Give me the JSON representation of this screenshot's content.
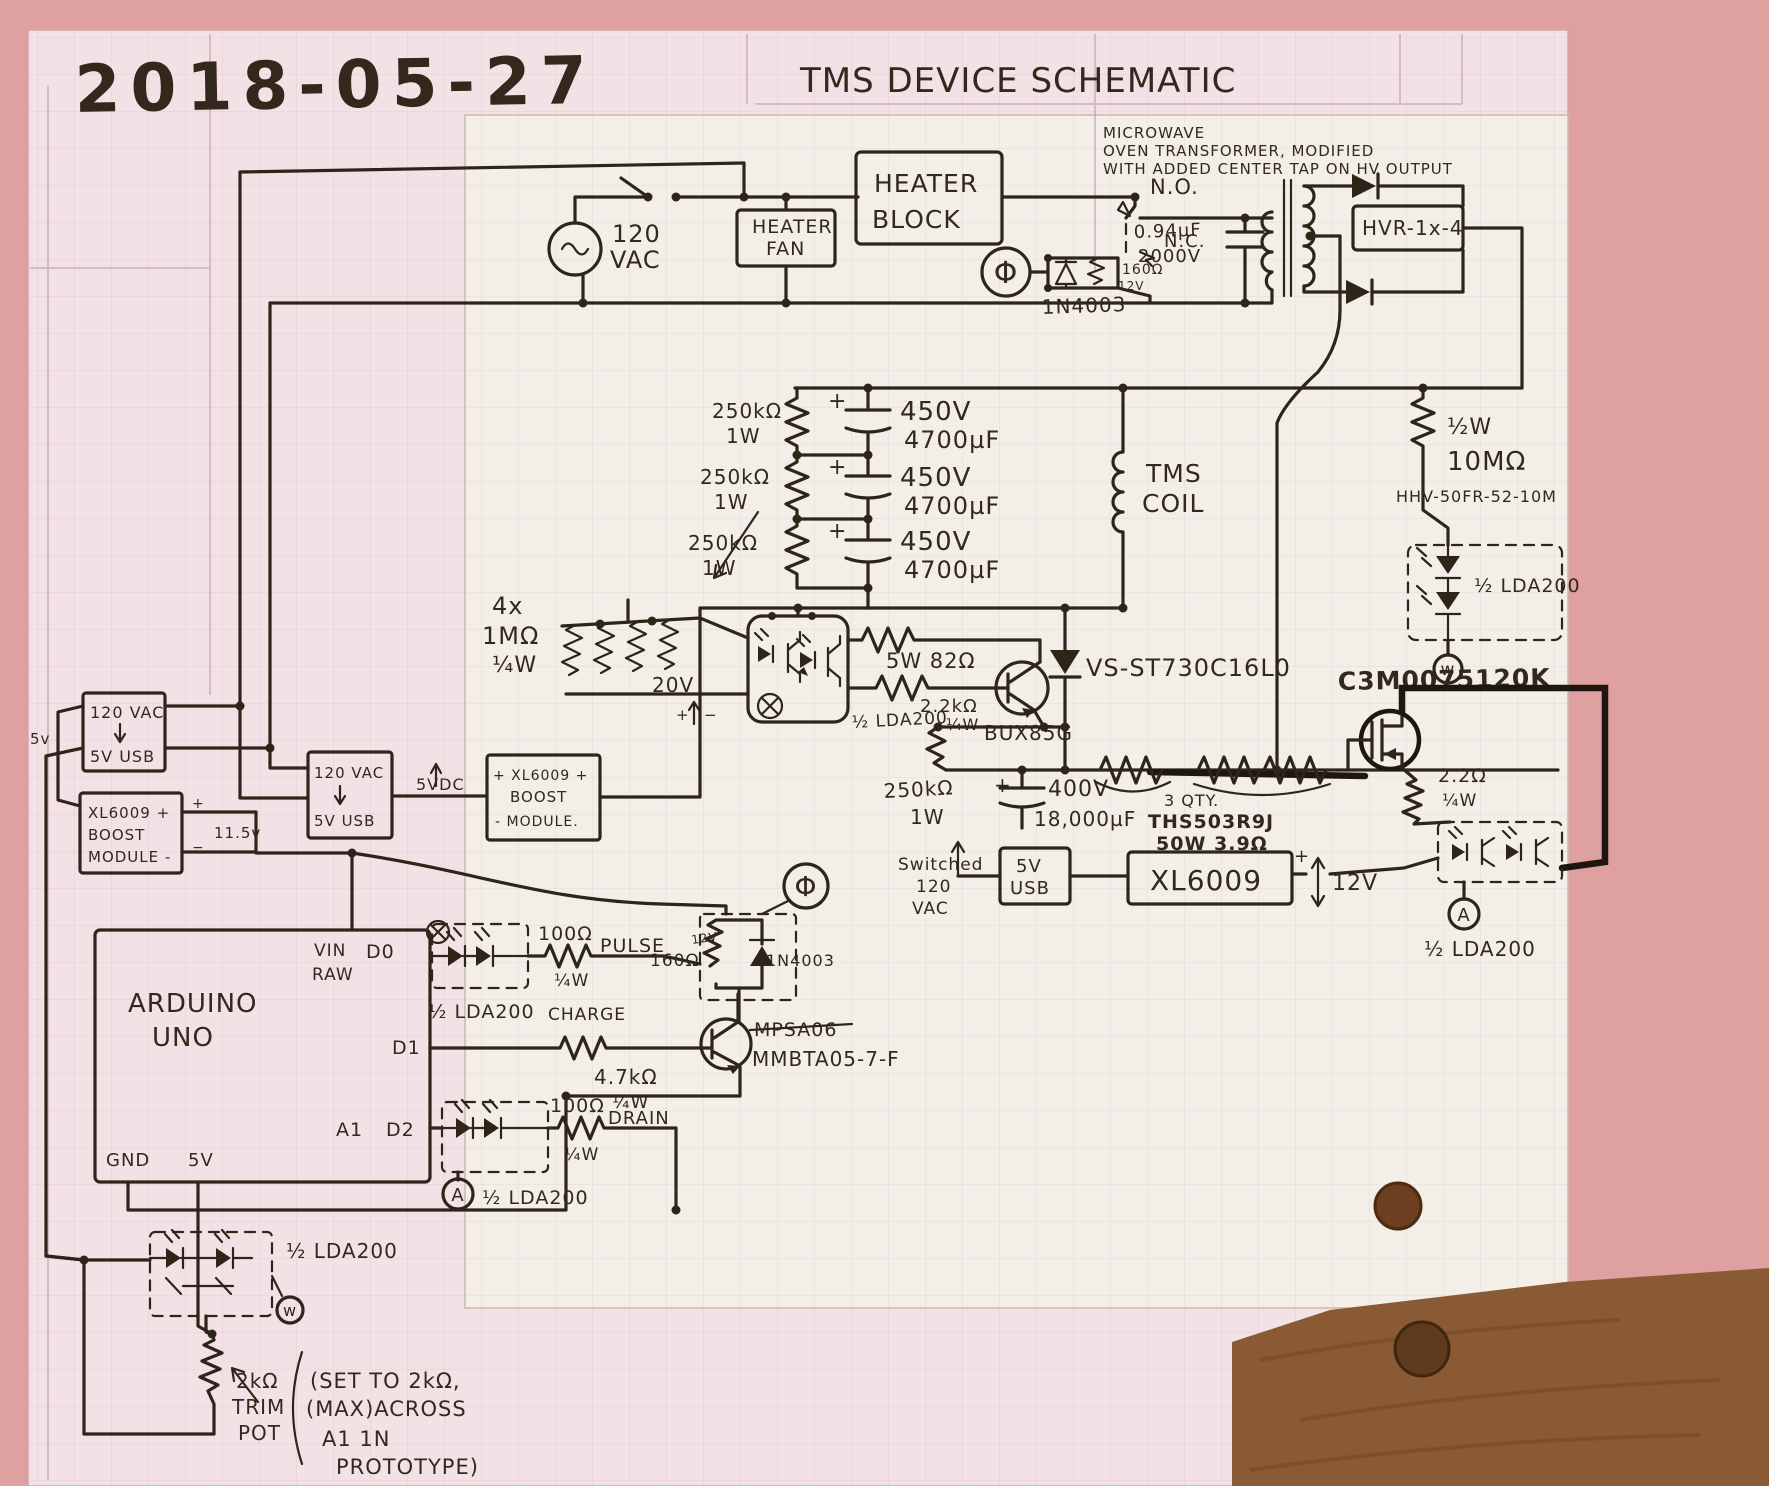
{
  "header": {
    "date": "2018-05-27",
    "title": "TMS DEVICE SCHEMATIC"
  },
  "transformer_note": {
    "l1": "MICROWAVE",
    "l2": "OVEN TRANSFORMER, MODIFIED",
    "l3": "WITH ADDED CENTER TAP ON HV OUTPUT"
  },
  "mains": {
    "v": "120",
    "unit": "VAC"
  },
  "heater": {
    "fan1": "HEATER",
    "fan2": "FAN",
    "block1": "HEATER",
    "block2": "BLOCK"
  },
  "relay_top": {
    "no": "N.O.",
    "nc": "N.C.",
    "cap1": "0.94µF",
    "cap2": "2000V",
    "coil_r": "160Ω",
    "coil_v": "12V",
    "diode": "1N4003"
  },
  "rectifier": {
    "part": "HVR-1x-4"
  },
  "bleed": {
    "half_w": "½W",
    "value": "10MΩ",
    "part": "HHV-50FR-52-10M"
  },
  "capbank": {
    "r": "250kΩ",
    "rw": "1W",
    "v": "450V",
    "c": "4700µF",
    "plus": "+"
  },
  "tms": {
    "l1": "TMS",
    "l2": "COIL"
  },
  "res4x": {
    "l1": "4x",
    "l2": "1MΩ",
    "l3": "¼W"
  },
  "common": {
    "lda": "½ LDA200",
    "qw": "¼W"
  },
  "drive": {
    "r82": "5W 82Ω",
    "r22k": "2.2kΩ",
    "bjt": "BUX85G",
    "scr": "VS-ST730C16L0"
  },
  "boost20": {
    "v": "20V",
    "plus": "+",
    "minus": "−"
  },
  "left": {
    "v5": "5v",
    "ac1": "120 VAC",
    "ac2": "5V USB",
    "bx1": "XL6009 +",
    "bx2": "BOOST",
    "bx3": "MODULE -",
    "v115": "11.5v",
    "plus": "+",
    "minus": "−"
  },
  "mid": {
    "vdc": "5VDC",
    "bx1": "+ XL6009 +",
    "bx2": "BOOST",
    "bx3": "- MODULE."
  },
  "discharge": {
    "r250": "250kΩ",
    "r250w": "1W",
    "cplus": "+",
    "cv": "400V",
    "cuf": "18,000µF",
    "qty": "3 QTY.",
    "part": "THS503R9J",
    "rating": "50W 3.9Ω",
    "fet": "C3M0075120K",
    "r22": "2.2Ω"
  },
  "arduino": {
    "l1": "ARDUINO",
    "l2": "UNO",
    "vin": "VIN",
    "raw": "RAW",
    "d0": "D0",
    "d1": "D1",
    "a1": "A1",
    "d2": "D2",
    "gnd": "GND",
    "v5": "5V"
  },
  "pulse": {
    "r100": "100Ω",
    "label": "PULSE",
    "charge": "CHARGE"
  },
  "relay_low": {
    "coil_r": "160Ω",
    "coil_v": "12V",
    "diode": "1N4003"
  },
  "charge": {
    "r47": "4.7kΩ",
    "old_part": "MPSA06",
    "part": "MMBTA05-7-F"
  },
  "drain": {
    "r100": "100Ω",
    "label": "DRAIN"
  },
  "right12": {
    "sw1": "Switched",
    "sw2": "120",
    "sw3": "VAC",
    "usb1": "5V",
    "usb2": "USB",
    "reg": "XL6009",
    "plus": "+",
    "v12": "12V"
  },
  "markers": {
    "w": "w",
    "a": "A",
    "phi": "Φ"
  },
  "pot": {
    "l1": "2kΩ",
    "l2": "TRIM",
    "l3": "POT",
    "n1": "(SET TO 2kΩ,",
    "n2": "(MAX)ACROSS",
    "n3": "A1 1N",
    "n4": "PROTOTYPE)"
  }
}
